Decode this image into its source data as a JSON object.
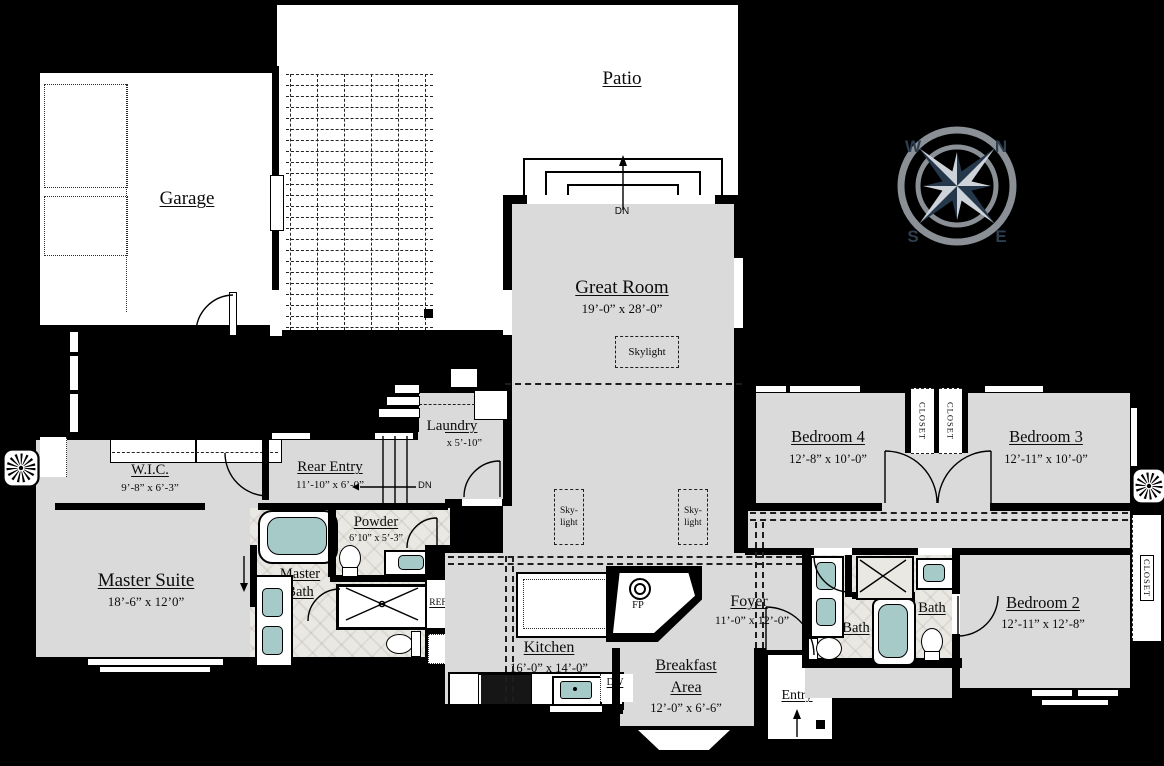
{
  "outdoor": {
    "patio": "Patio",
    "garage": "Garage"
  },
  "compass": {
    "w": "W",
    "n": "N",
    "s": "S",
    "e": "E"
  },
  "rooms": {
    "great_room": {
      "name": "Great Room",
      "dims": "19’-0” x 28’-0”"
    },
    "laundry": {
      "name": "Laundry",
      "dims": "7’-0” x 5’-10”"
    },
    "wic": {
      "name": "W.I.C.",
      "dims": "9’-8” x 6’-3”"
    },
    "rear_entry": {
      "name": "Rear Entry",
      "dims": "11’-10” x 6’-0”"
    },
    "master_suite": {
      "name": "Master Suite",
      "dims": "18’-6” x 12’0”"
    },
    "master_bath": {
      "name_line1": "Master",
      "name_line2": "Bath"
    },
    "powder": {
      "name": "Powder",
      "dims": "6’10” x 5’-3”"
    },
    "kitchen": {
      "name": "Kitchen",
      "dims": "16’-0” x 14’-0”"
    },
    "breakfast": {
      "name_line1": "Breakfast",
      "name_line2": "Area",
      "dims": "12’-0” x 6’-6”"
    },
    "foyer": {
      "name": "Foyer",
      "dims": "11’-0” x 12’-0”"
    },
    "entry": {
      "name": "Entry"
    },
    "bath_hall": {
      "name": "Bath"
    },
    "bath_secondary": {
      "name": "Bath"
    },
    "bedroom4": {
      "name": "Bedroom 4",
      "dims": "12’-8” x 10’-0”"
    },
    "bedroom3": {
      "name": "Bedroom 3",
      "dims": "12’-11” x 10’-0”"
    },
    "bedroom2": {
      "name": "Bedroom 2",
      "dims": "12’-11” x 12’-8”"
    }
  },
  "features": {
    "skylight_main": "Skylight",
    "skylight_small_line1": "Sky-",
    "skylight_small_line2": "light",
    "closet": "CLOSET",
    "dn": "DN",
    "ref": "REF",
    "dw": "DW",
    "fp": "FP"
  },
  "colors": {
    "wall": "#000000",
    "floor": "#dadada",
    "outdoor": "#ffffff",
    "fixture": "#a6cac8",
    "tile": "#eae8e3",
    "compass_dark": "#25384b",
    "compass_light": "#cdd3d8",
    "compass_ring": "#8a9096"
  }
}
